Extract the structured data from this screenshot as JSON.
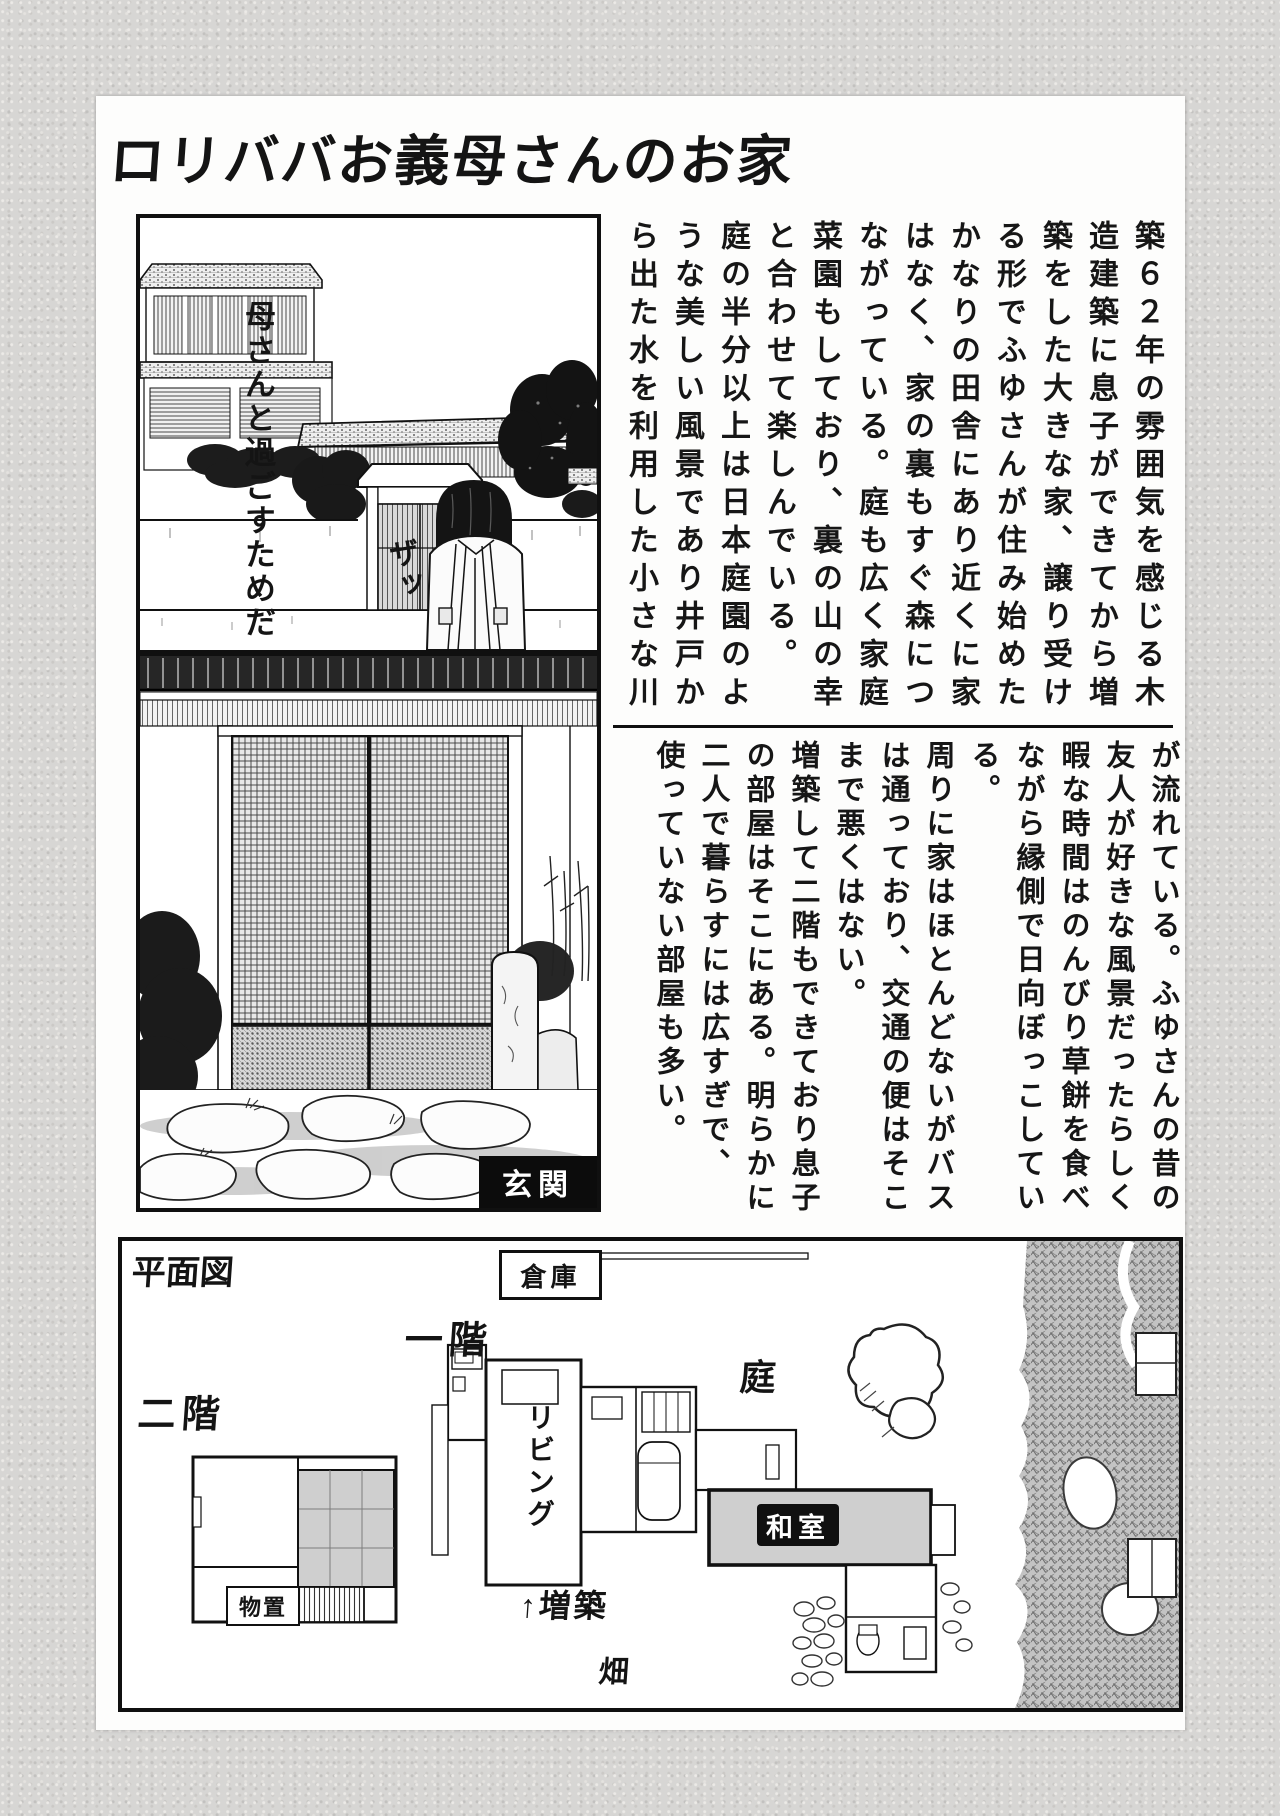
{
  "page": {
    "title": "ロリババお義母さんのお家"
  },
  "panel_house_exterior": {
    "dialogue": "母さんと過ごすためだ",
    "sfx": "ザッ"
  },
  "intro_text": {
    "columns": [
      "築６２年の雰囲気を感じる木",
      "造建築に息子ができてから増",
      "築をした大きな家、譲り受け",
      "る形でふゆさんが住み始めた",
      "かなりの田舎にあり近くに家",
      "はなく、家の裏もすぐ森につ",
      "ながっている。庭も広く家庭",
      "菜園もしており、裏の山の幸",
      "と合わせて楽しんでいる。",
      "庭の半分以上は日本庭園のよ",
      "うな美しい風景であり井戸か",
      "ら出た水を利用した小さな川"
    ]
  },
  "detail_text": {
    "columns": [
      "が流れている。ふゆさんの昔の",
      "友人が好きな風景だったらしく",
      "暇な時間はのんびり草餅を食べ",
      "ながら縁側で日向ぼっこしてい",
      "る。",
      "周りに家はほとんどないがバス",
      "は通っており、交通の便はそこ",
      "まで悪くはない。",
      "増築して二階もできており息子",
      "の部屋はそこにある。明らかに",
      "二人で暮らすには広すぎで、",
      "使っていない部屋も多い。"
    ]
  },
  "panel_entrance": {
    "label": "玄関"
  },
  "floor_plan": {
    "title": "平面図",
    "warehouse": "倉庫",
    "first_floor": "一階",
    "second_floor": "二階",
    "garden": "庭",
    "living_room": "リビング",
    "japanese_room": "和室",
    "extension": "↑増築",
    "field": "畑",
    "storage": "物置"
  }
}
